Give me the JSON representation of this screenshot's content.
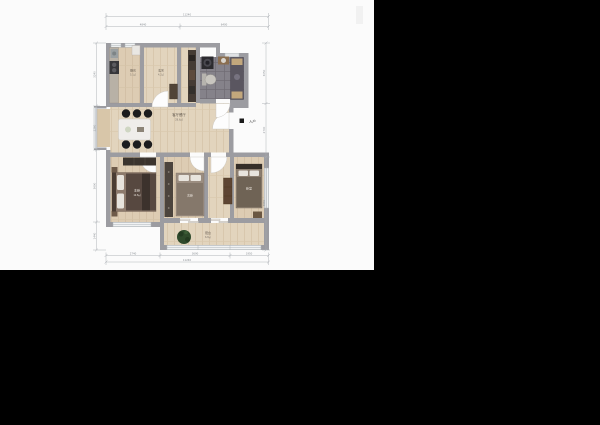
{
  "window": {
    "background": "#000000",
    "canvas": "#fbfbfb"
  },
  "colors": {
    "wall": "#9c9ca1",
    "wood_floor": "#ddccb3",
    "wood_floor_light": "#e3d6c0",
    "bath_tile": "#85828a",
    "furniture_dark": "#3b342e",
    "dimension": "#9ba1a7",
    "plant": "#2f4a2b"
  },
  "plan": {
    "rooms": {
      "kitchen": {
        "name": "厨房",
        "area": "5.1㎡"
      },
      "entry": {
        "name": "玄关",
        "area": "4.2㎡"
      },
      "living": {
        "name": "客厅餐厅",
        "area": "28.6㎡"
      },
      "master_bedroom": {
        "name": "主卧",
        "area": "12.8㎡"
      },
      "second_bedroom": {
        "name": "次卧",
        "area": "9.6㎡"
      },
      "right_bedroom": {
        "name": "卧室",
        "area": "10.4㎡"
      },
      "balcony": {
        "name": "阳台",
        "area": "6.8㎡"
      }
    },
    "entry_marker": "入户",
    "dims": {
      "top_total": "11240",
      "top_a": "4840",
      "top_b": "6400",
      "left_a": "3240",
      "left_b": "2260",
      "left_c": "3690",
      "left_d": "1440",
      "right_a": "3050",
      "right_b": "2700",
      "right_c": "4660",
      "bottom_a": "2740",
      "bottom_b": "3690",
      "bottom_c": "1950",
      "bottom_total": "11240"
    }
  }
}
